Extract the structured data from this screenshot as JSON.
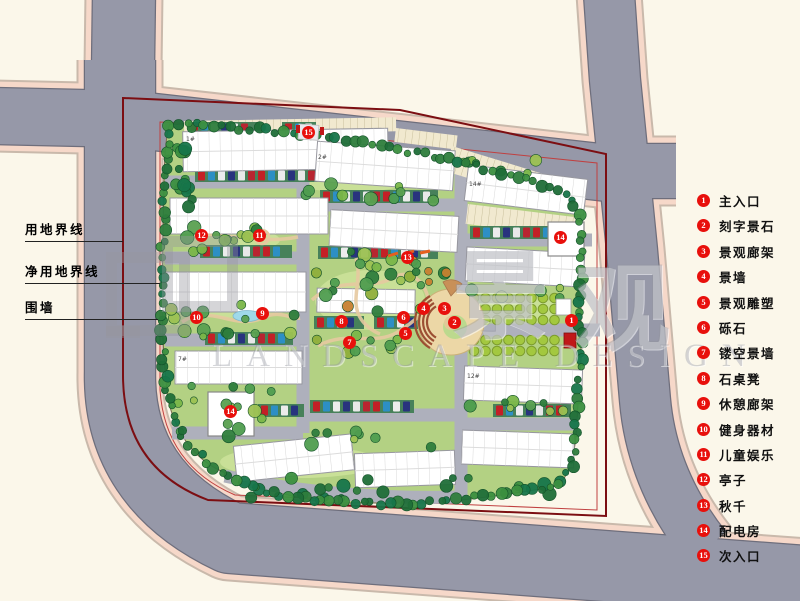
{
  "legend": {
    "items": [
      {
        "num": "1",
        "label": "主入口"
      },
      {
        "num": "2",
        "label": "刻字景石"
      },
      {
        "num": "3",
        "label": "景观廊架"
      },
      {
        "num": "4",
        "label": "景墙"
      },
      {
        "num": "5",
        "label": "景观雕塑"
      },
      {
        "num": "6",
        "label": "砾石"
      },
      {
        "num": "7",
        "label": "镂空景墙"
      },
      {
        "num": "8",
        "label": "石桌凳"
      },
      {
        "num": "9",
        "label": "休憩廊架"
      },
      {
        "num": "10",
        "label": "健身器材"
      },
      {
        "num": "11",
        "label": "儿童娱乐"
      },
      {
        "num": "12",
        "label": "亭子"
      },
      {
        "num": "13",
        "label": "秋千"
      },
      {
        "num": "14",
        "label": "配电房"
      },
      {
        "num": "15",
        "label": "次入口"
      }
    ]
  },
  "boundary_labels": {
    "land_use": "用地界线",
    "net_land_use": "净用地界线",
    "wall": "围墙"
  },
  "markers": [
    {
      "num": "15"
    },
    {
      "num": "12"
    },
    {
      "num": "11"
    },
    {
      "num": "14"
    },
    {
      "num": "13"
    },
    {
      "num": "1"
    },
    {
      "num": "2"
    },
    {
      "num": "3"
    },
    {
      "num": "4"
    },
    {
      "num": "5"
    },
    {
      "num": "6"
    },
    {
      "num": "7"
    },
    {
      "num": "8"
    },
    {
      "num": "9"
    },
    {
      "num": "10"
    },
    {
      "num": "14"
    }
  ],
  "building_labels": [
    {
      "text": "1#"
    },
    {
      "text": "2#"
    },
    {
      "text": "14#"
    },
    {
      "text": "7#"
    },
    {
      "text": "12#"
    }
  ],
  "watermark": {
    "cn_1": "景",
    "cn_2": "观",
    "en": "LANDSCAPE DESIGN"
  },
  "colors": {
    "background": "#fbf7ea",
    "road": "#9698a8",
    "sidewalk": "#f6d8c9",
    "site_green": "#b3d183",
    "land_use_boundary": "#7c0e12",
    "net_boundary": "#c04040",
    "legend_dot": "#e8100c",
    "plaza_tan": "#ecd7a6"
  }
}
